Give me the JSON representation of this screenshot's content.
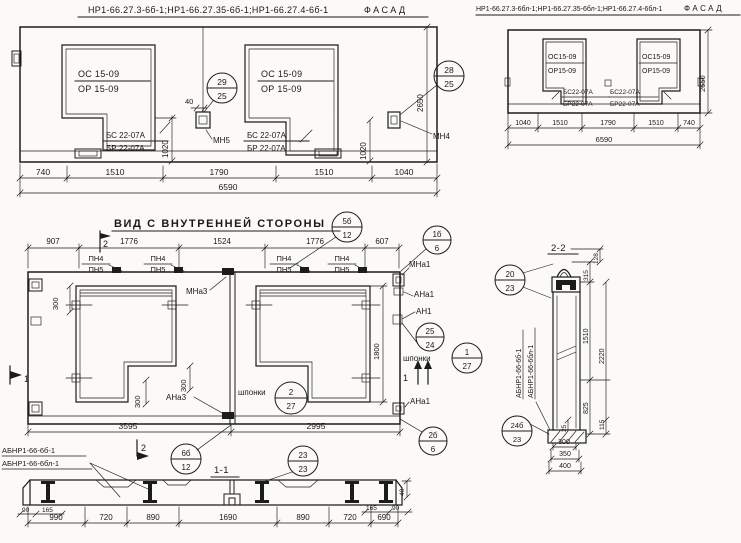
{
  "colors": {
    "paper": "#fbfaf6",
    "ink": "#1c1c1c"
  },
  "fl": {
    "title": "НР1-66.27.3-6б-1;НР1-66.27.35-6б-1;НР1-66.27.4-6б-1",
    "title2": "ФАСАД",
    "w1a": "ОС 15-09",
    "w1b": "ОР 15-09",
    "w1c": "БС 22-07А",
    "w1d": "БР 22-07А",
    "w2a": "ОС 15-09",
    "w2b": "ОР 15-09",
    "w2c": "БС 22-07А",
    "w2d": "БР 22-07А",
    "d40": "40",
    "d1020a": "1020",
    "d1020b": "1020",
    "d2650": "2650",
    "mn5": "МН5",
    "mn4": "МН4",
    "c1t": "29",
    "c1b": "25",
    "c2t": "28",
    "c2b": "25",
    "dims": [
      "740",
      "1510",
      "1790",
      "1510",
      "1040"
    ],
    "total": "6590"
  },
  "fr": {
    "title": "НР1-66.27.3-6бл-1;НР1-66.27.35-6бл-1;НР1-66.27.4-6бл-1",
    "title2": "ФАСАД",
    "w1a": "ОС15-09",
    "w1b": "ОР15-09",
    "w1c": "БС22-07А",
    "w1d": "БР22-07А",
    "w2a": "ОС15-09",
    "w2b": "ОР15-09",
    "w2c": "БС22-07А",
    "w2d": "БР22-07А",
    "d2650": "2650",
    "dims": [
      "1040",
      "1510",
      "1790",
      "1510",
      "740"
    ],
    "total": "6590"
  },
  "mid": {
    "title": "ВИД С ВНУТРЕННЕЙ СТОРОНЫ",
    "dims_top": [
      "907",
      "1776",
      "1524",
      "1776",
      "607"
    ],
    "dims_bot": [
      "3595",
      "2995"
    ],
    "pn4": "ПН4",
    "pn5": "ПН5",
    "mna3": "МНа3",
    "ana3": "АНа3",
    "mna1": "МНа1",
    "ana1": "АНа1",
    "an1": "АН1",
    "ana1b": "АНа1",
    "shponki": "шпонки",
    "d300": "300",
    "d1800": "1800",
    "sec1": "1",
    "sec2": "2",
    "c5t": "5б",
    "c5b": "12",
    "c1bt": "1б",
    "c1bb": "6",
    "c25t": "25",
    "c25b": "24",
    "csh1t": "1",
    "csh1b": "27",
    "csh2t": "2",
    "csh2b": "27",
    "c2bt": "2б",
    "c2bb": "6",
    "c6bt": "6б",
    "c6bb": "12"
  },
  "bl": {
    "l1": "АБНР1-66-6б-1",
    "l2": "АБНР1-66-6бл-1"
  },
  "s11": {
    "title": "1-1",
    "c23t": "23",
    "c23b": "23",
    "dims": [
      "990",
      "720",
      "890",
      "1690",
      "890",
      "720",
      "690"
    ],
    "d90l": "90",
    "d165l": "165",
    "d165r": "165",
    "d90r": "90",
    "d40": "40"
  },
  "s22": {
    "title": "2-2",
    "c20t": "20",
    "c20b": "23",
    "c24t": "24б",
    "c24b": "23",
    "d128": "128",
    "d315": "315",
    "d1510": "1510",
    "d2220": "2220",
    "d825": "825",
    "d115": "115",
    "d25": "25",
    "dims_bot": [
      "300",
      "350",
      "400"
    ],
    "l1": "АБНР1-66-6б-1",
    "l2": "АБНР1-66-6бл-1"
  }
}
